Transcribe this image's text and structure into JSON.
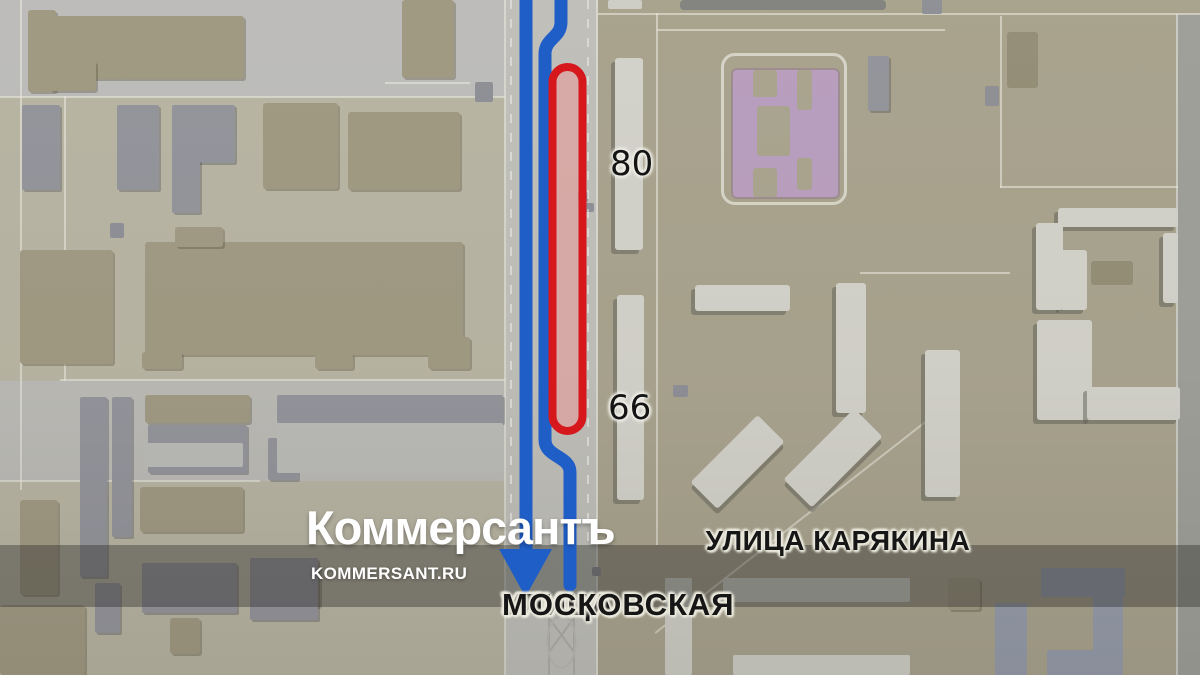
{
  "watermark": {
    "logo": "Коммерсантъ",
    "site": "KOMMERSANT.RU"
  },
  "map": {
    "labels": {
      "house_80": "80",
      "house_66": "66",
      "street_karyakina": "УЛИЦА КАРЯКИНА",
      "street_moskovskaya_line1": "УЛИЦА",
      "street_moskovskaya_line2": "МОСКОВСКАЯ"
    },
    "colors": {
      "route_blue": "#1f5ec6",
      "closure_red": "#d6171c",
      "closure_fill": "rgba(239,150,150,0.5)",
      "building_pink": "#c2a6c8",
      "ground_left": "#c1bdab",
      "ground_right": "#b1ab95",
      "asphalt": "#c6c5c3",
      "road": "#c9c8c2"
    },
    "zones": [
      {
        "x": 0,
        "y": 0,
        "w": 505,
        "h": 675,
        "f": "#c1bdab"
      },
      {
        "x": 505,
        "y": 0,
        "w": 695,
        "h": 675,
        "f": "#b1ab95"
      },
      {
        "x": 0,
        "y": 0,
        "w": 505,
        "h": 97,
        "f": "#c6c5c3"
      },
      {
        "x": 0,
        "y": 381,
        "w": 505,
        "h": 100,
        "f": "#c4c3be"
      },
      {
        "x": 505,
        "y": 0,
        "w": 93,
        "h": 675,
        "f": "#c9c8c2"
      },
      {
        "x": 1176,
        "y": 14,
        "w": 24,
        "h": 661,
        "f": "#a7a7a1"
      }
    ],
    "road_lines": [
      {
        "x": 0,
        "y": 96,
        "w": 505,
        "h": 2
      },
      {
        "x": 60,
        "y": 379,
        "w": 445,
        "h": 2
      },
      {
        "x": 0,
        "y": 480,
        "w": 260,
        "h": 2
      },
      {
        "x": 64,
        "y": 96,
        "w": 2,
        "h": 285
      },
      {
        "x": 20,
        "y": 0,
        "w": 2,
        "h": 490
      },
      {
        "x": 504,
        "y": 0,
        "w": 2,
        "h": 675
      },
      {
        "x": 596,
        "y": 0,
        "w": 2,
        "h": 675
      },
      {
        "x": 598,
        "y": 13,
        "w": 602,
        "h": 2
      },
      {
        "x": 656,
        "y": 13,
        "w": 2,
        "h": 532
      },
      {
        "x": 657,
        "y": 29,
        "w": 288,
        "h": 2
      },
      {
        "x": 1000,
        "y": 16,
        "w": 2,
        "h": 172
      },
      {
        "x": 1000,
        "y": 186,
        "w": 178,
        "h": 2
      },
      {
        "x": 860,
        "y": 272,
        "w": 150,
        "h": 2
      },
      {
        "x": 1176,
        "y": 14,
        "w": 2,
        "h": 661
      },
      {
        "x": 615,
        "y": 515,
        "w": 380,
        "h": 2,
        "r": -38
      },
      {
        "x": 385,
        "y": 82,
        "w": 85,
        "h": 2
      }
    ],
    "buildings": [
      {
        "x": 28,
        "y": 10,
        "w": 28,
        "h": 82,
        "c": "tan"
      },
      {
        "x": 48,
        "y": 16,
        "w": 196,
        "h": 63,
        "c": "tan"
      },
      {
        "x": 50,
        "y": 61,
        "w": 46,
        "h": 30,
        "c": "tan"
      },
      {
        "x": 402,
        "y": 0,
        "w": 52,
        "h": 78,
        "c": "tan"
      },
      {
        "x": 263,
        "y": 103,
        "w": 75,
        "h": 86,
        "c": "tan"
      },
      {
        "x": 348,
        "y": 112,
        "w": 112,
        "h": 78,
        "c": "tan"
      },
      {
        "x": 20,
        "y": 250,
        "w": 93,
        "h": 114,
        "c": "tan"
      },
      {
        "x": 145,
        "y": 242,
        "w": 318,
        "h": 113,
        "c": "tan"
      },
      {
        "x": 175,
        "y": 227,
        "w": 48,
        "h": 20,
        "c": "tan"
      },
      {
        "x": 142,
        "y": 352,
        "w": 40,
        "h": 17,
        "c": "tan"
      },
      {
        "x": 315,
        "y": 353,
        "w": 38,
        "h": 16,
        "c": "tan"
      },
      {
        "x": 428,
        "y": 337,
        "w": 42,
        "h": 32,
        "c": "tan"
      },
      {
        "x": 145,
        "y": 395,
        "w": 105,
        "h": 28,
        "c": "tan"
      },
      {
        "x": 140,
        "y": 487,
        "w": 103,
        "h": 45,
        "c": "tan"
      },
      {
        "x": 20,
        "y": 500,
        "w": 38,
        "h": 95,
        "c": "tan"
      },
      {
        "x": 0,
        "y": 605,
        "w": 85,
        "h": 70,
        "c": "tan"
      },
      {
        "x": 265,
        "y": 563,
        "w": 55,
        "h": 44,
        "c": "tan"
      },
      {
        "x": 170,
        "y": 618,
        "w": 30,
        "h": 36,
        "c": "tan"
      },
      {
        "x": 948,
        "y": 578,
        "w": 32,
        "h": 32,
        "c": "tan"
      },
      {
        "x": 1007,
        "y": 32,
        "w": 31,
        "h": 56,
        "c": "tand"
      },
      {
        "x": 1091,
        "y": 261,
        "w": 42,
        "h": 24,
        "c": "tand"
      },
      {
        "x": 22,
        "y": 105,
        "w": 38,
        "h": 85,
        "c": "gray"
      },
      {
        "x": 117,
        "y": 105,
        "w": 42,
        "h": 85,
        "c": "gray"
      },
      {
        "x": 172,
        "y": 105,
        "w": 63,
        "h": 58,
        "c": "gray"
      },
      {
        "x": 172,
        "y": 160,
        "w": 28,
        "h": 53,
        "c": "gray"
      },
      {
        "x": 80,
        "y": 397,
        "w": 27,
        "h": 180,
        "c": "gray"
      },
      {
        "x": 112,
        "y": 397,
        "w": 20,
        "h": 140,
        "c": "gray"
      },
      {
        "x": 148,
        "y": 425,
        "w": 99,
        "h": 48,
        "c": "gray"
      },
      {
        "x": 268,
        "y": 438,
        "w": 30,
        "h": 42,
        "c": "gray"
      },
      {
        "x": 277,
        "y": 395,
        "w": 226,
        "h": 28,
        "c": "gray"
      },
      {
        "x": 95,
        "y": 583,
        "w": 25,
        "h": 50,
        "c": "gray"
      },
      {
        "x": 142,
        "y": 563,
        "w": 95,
        "h": 50,
        "c": "gray"
      },
      {
        "x": 250,
        "y": 558,
        "w": 68,
        "h": 62,
        "c": "gray"
      },
      {
        "x": 868,
        "y": 56,
        "w": 21,
        "h": 55,
        "c": "gray"
      },
      {
        "x": 110,
        "y": 223,
        "w": 14,
        "h": 15,
        "c": "gflat"
      },
      {
        "x": 308,
        "y": 440,
        "w": 14,
        "h": 13,
        "c": "gflat"
      },
      {
        "x": 475,
        "y": 82,
        "w": 18,
        "h": 20,
        "c": "gflat"
      },
      {
        "x": 578,
        "y": 192,
        "w": 10,
        "h": 10,
        "c": "gflat"
      },
      {
        "x": 585,
        "y": 203,
        "w": 9,
        "h": 9,
        "c": "gflat"
      },
      {
        "x": 673,
        "y": 385,
        "w": 15,
        "h": 12,
        "c": "gflat"
      },
      {
        "x": 592,
        "y": 567,
        "w": 9,
        "h": 9,
        "c": "gflat"
      },
      {
        "x": 922,
        "y": 0,
        "w": 20,
        "h": 14,
        "c": "gflat"
      },
      {
        "x": 985,
        "y": 86,
        "w": 14,
        "h": 20,
        "c": "gflat"
      },
      {
        "x": 277,
        "y": 423,
        "w": 226,
        "h": 50,
        "c": "lgray"
      },
      {
        "x": 143,
        "y": 443,
        "w": 100,
        "h": 24,
        "c": "lgray"
      },
      {
        "x": 680,
        "y": 0,
        "w": 206,
        "h": 10,
        "c": "dgray"
      },
      {
        "x": 615,
        "y": 58,
        "w": 28,
        "h": 192,
        "c": "white"
      },
      {
        "x": 617,
        "y": 295,
        "w": 27,
        "h": 205,
        "c": "white"
      },
      {
        "x": 695,
        "y": 285,
        "w": 95,
        "h": 26,
        "c": "white"
      },
      {
        "x": 836,
        "y": 283,
        "w": 30,
        "h": 130,
        "c": "white"
      },
      {
        "x": 690,
        "y": 443,
        "w": 95,
        "h": 38,
        "c": "white",
        "r": -45
      },
      {
        "x": 783,
        "y": 438,
        "w": 100,
        "h": 40,
        "c": "white",
        "r": -45
      },
      {
        "x": 925,
        "y": 350,
        "w": 35,
        "h": 147,
        "c": "white"
      },
      {
        "x": 1060,
        "y": 250,
        "w": 27,
        "h": 60,
        "c": "white"
      },
      {
        "x": 1037,
        "y": 320,
        "w": 55,
        "h": 100,
        "c": "white"
      },
      {
        "x": 1087,
        "y": 387,
        "w": 93,
        "h": 33,
        "c": "white"
      },
      {
        "x": 1058,
        "y": 208,
        "w": 120,
        "h": 19,
        "c": "white"
      },
      {
        "x": 1036,
        "y": 223,
        "w": 27,
        "h": 87,
        "c": "white"
      },
      {
        "x": 1163,
        "y": 233,
        "w": 15,
        "h": 70,
        "c": "white"
      },
      {
        "x": 608,
        "y": 0,
        "w": 34,
        "h": 9,
        "c": "wflat"
      },
      {
        "x": 665,
        "y": 578,
        "w": 27,
        "h": 97,
        "c": "wflat"
      },
      {
        "x": 723,
        "y": 578,
        "w": 187,
        "h": 24,
        "c": "wflat"
      },
      {
        "x": 733,
        "y": 655,
        "w": 177,
        "h": 20,
        "c": "wflat"
      },
      {
        "x": 1041,
        "y": 568,
        "w": 84,
        "h": 29,
        "c": "bgray"
      },
      {
        "x": 1093,
        "y": 595,
        "w": 30,
        "h": 80,
        "c": "bgray"
      },
      {
        "x": 1047,
        "y": 650,
        "w": 50,
        "h": 25,
        "c": "bgray"
      },
      {
        "x": 995,
        "y": 603,
        "w": 32,
        "h": 72,
        "c": "bgray"
      }
    ],
    "pink_building": {
      "base": {
        "x": 733,
        "y": 70,
        "w": 105,
        "h": 127
      },
      "outline": {
        "x": 721,
        "y": 53,
        "w": 126,
        "h": 152
      },
      "cutouts": [
        {
          "x": 753,
          "y": 70,
          "w": 24,
          "h": 27
        },
        {
          "x": 797,
          "y": 70,
          "w": 15,
          "h": 40
        },
        {
          "x": 753,
          "y": 168,
          "w": 24,
          "h": 29
        },
        {
          "x": 797,
          "y": 158,
          "w": 15,
          "h": 32
        },
        {
          "x": 757,
          "y": 106,
          "w": 33,
          "h": 50
        }
      ]
    }
  }
}
